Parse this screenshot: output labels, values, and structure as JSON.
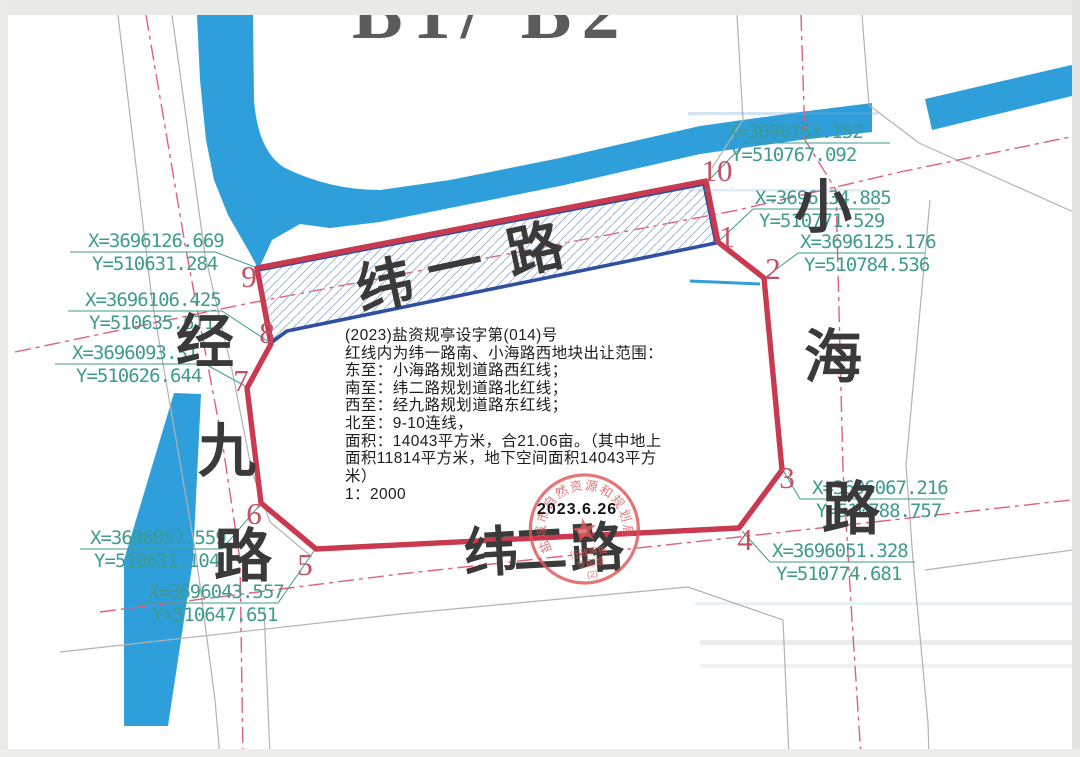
{
  "document": {
    "top_label": "B1/ B2",
    "doc_no": "(2023)盐资规亭设字第(014)号",
    "intro": "红线内为纬一路南、小海路西地块出让范围：",
    "east_line": "东至：小海路规划道路西红线；",
    "south_line": "南至：纬二路规划道路北红线；",
    "west_line": "西至：经九路规划道路东红线；",
    "north_line": "北至：9-10连线，",
    "area1": "面积：14043平方米，合21.06亩。（其中地上",
    "area2": "面积11814平方米，地下空间面积14043平方",
    "area3": "米）",
    "scale": "1：2000",
    "date": "2023.6.26"
  },
  "roads": {
    "north": "纬一路",
    "south": "纬二路",
    "west": "经九路",
    "east": "小海路"
  },
  "points": [
    {
      "id": "10",
      "x": "X=3696153.152",
      "y": "Y=510767.092"
    },
    {
      "id": "1",
      "x": "X=3696134.885",
      "y": "Y=510771.529"
    },
    {
      "id": "2",
      "x": "X=3696125.176",
      "y": "Y=510784.536"
    },
    {
      "id": "3",
      "x": "X=3696067.216",
      "y": "Y=510788.757"
    },
    {
      "id": "4",
      "x": "X=3696051.328",
      "y": "Y=510774.681"
    },
    {
      "id": "5",
      "x": "X=3696043.557",
      "y": "Y=510647.651"
    },
    {
      "id": "6",
      "x": "X=3696057.559",
      "y": "Y=510631.104"
    },
    {
      "id": "7",
      "x": "X=3696093.31",
      "y": "Y=510626.644"
    },
    {
      "id": "8",
      "x": "X=3696106.425",
      "y": "Y=510635.671"
    },
    {
      "id": "9",
      "x": "X=3696126.669",
      "y": "Y=510631.284"
    }
  ],
  "seal": {
    "arc_text": "盐城市自然资源和规划局",
    "sub_text1": "行政审批",
    "sub_text2": "专用章",
    "number": "(2)"
  },
  "colors": {
    "water": "#2E9FDA",
    "red_line": "#C9394F",
    "blue_line": "#2F4FA0",
    "hatch": "#9CB6DE",
    "teal": "#3E9B8E",
    "centerline": "#E0607C",
    "point_red": "#C35064",
    "road_edge": "#B2B2B2",
    "seal_red": "#DE5858"
  }
}
